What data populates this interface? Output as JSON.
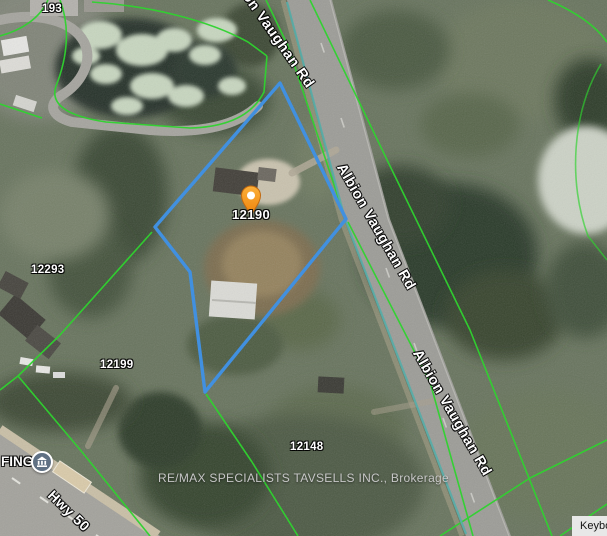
{
  "map": {
    "type": "satellite",
    "selected_property": {
      "number": "12190",
      "marker_color": "#F49A20",
      "boundary_color": "#4190E0"
    },
    "road_labels": [
      {
        "id": "albion-vaughan-rd-top",
        "text": "Albion Vaughan Rd"
      },
      {
        "id": "albion-vaughan-rd-mid",
        "text": "Albion Vaughan Rd"
      },
      {
        "id": "albion-vaughan-rd-bottom",
        "text": "Albion Vaughan Rd"
      },
      {
        "id": "hwy-50",
        "text": "Hwy 50"
      }
    ],
    "parcel_labels": [
      {
        "text": "193"
      },
      {
        "text": "12293"
      },
      {
        "text": "12199"
      },
      {
        "text": "12148"
      }
    ],
    "poi": {
      "label_partial": "FING",
      "icon": "civic-building-icon"
    },
    "attribution": "RE/MAX SPECIALISTS TAVSELLS INC., Brokerage",
    "keyboard_shortcuts_button": {
      "visible_text": "Keybo"
    },
    "line_colors": {
      "parcel_boundary_green": "#2FD32F",
      "road_overlay_teal": "#58ACA8",
      "selection_blue": "#4190E0"
    }
  }
}
